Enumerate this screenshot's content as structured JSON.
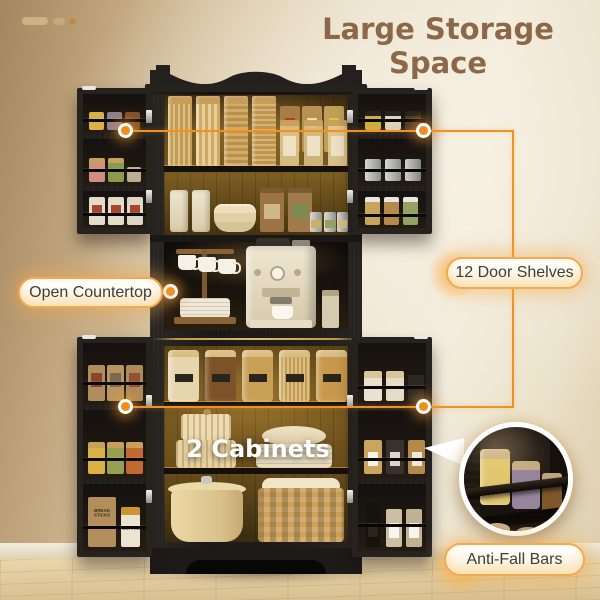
{
  "title": "Large Storage Space",
  "decoration": "dash-dash-dot",
  "callouts": {
    "open_countertop": {
      "label": "Open Countertop"
    },
    "door_shelves": {
      "label": "12 Door Shelves"
    },
    "cabinets": {
      "label": "2 Cabinets"
    },
    "anti_fall_bars": {
      "label": "Anti-Fall Bars"
    }
  },
  "products": {
    "bread_bag_label": "BREAD STICKS",
    "coffee_canister_label": "COFFEE"
  },
  "colors": {
    "accent_orange": "#f09124",
    "title_brown": "#8a6848",
    "pill_border": "#f3a94e",
    "pill_text": "#3e3d3b",
    "cabinet_black": "#1f1d1b",
    "wall_dark": "#a2875f",
    "wall_light": "#f1ead9",
    "floor_wood": "#e0cba0",
    "interior_glow": "#7c5d22",
    "photo_label_white": "#ffffff"
  },
  "cabinet_contents": {
    "upper_shelf_top": [
      "pasta-jar",
      "pasta-jar",
      "pasta-jar",
      "pasta-jar",
      "pantry-box",
      "pantry-box",
      "pantry-box",
      "label-jar",
      "label-jar",
      "label-jar"
    ],
    "upper_shelf_bottom": [
      "canister",
      "canister",
      "bowl-stack",
      "coffee-bag",
      "coffee-bag",
      "tea-tin",
      "tea-tin",
      "tea-tin"
    ],
    "countertop": [
      "mug-rack",
      "mug",
      "mug",
      "mug",
      "plate-stack",
      "espresso-machine",
      "coffee-cup",
      "coffee-bag"
    ],
    "lower_shelf_top": [
      "snack-jar",
      "bean-jar",
      "granola-jar",
      "spaghetti-jar",
      "cereal-jar"
    ],
    "lower_shelf_middle": [
      "round-box-stack",
      "bowl",
      "plate-stack"
    ],
    "lower_shelf_bottom": [
      "lidded-pot",
      "wicker-basket"
    ],
    "left_door_upper": [
      "spice-jars",
      "salt-and-herb-jars",
      "tea-boxes"
    ],
    "left_door_lower": [
      "paper-bags",
      "grain-jars",
      "bread-sticks-bag",
      "coffee-canister"
    ],
    "right_door_upper": [
      "spice-jars",
      "metal-tins",
      "seed-jars"
    ],
    "right_door_lower": [
      "white-canisters",
      "labeled-jars",
      "oil-and-spice-bottles"
    ]
  }
}
